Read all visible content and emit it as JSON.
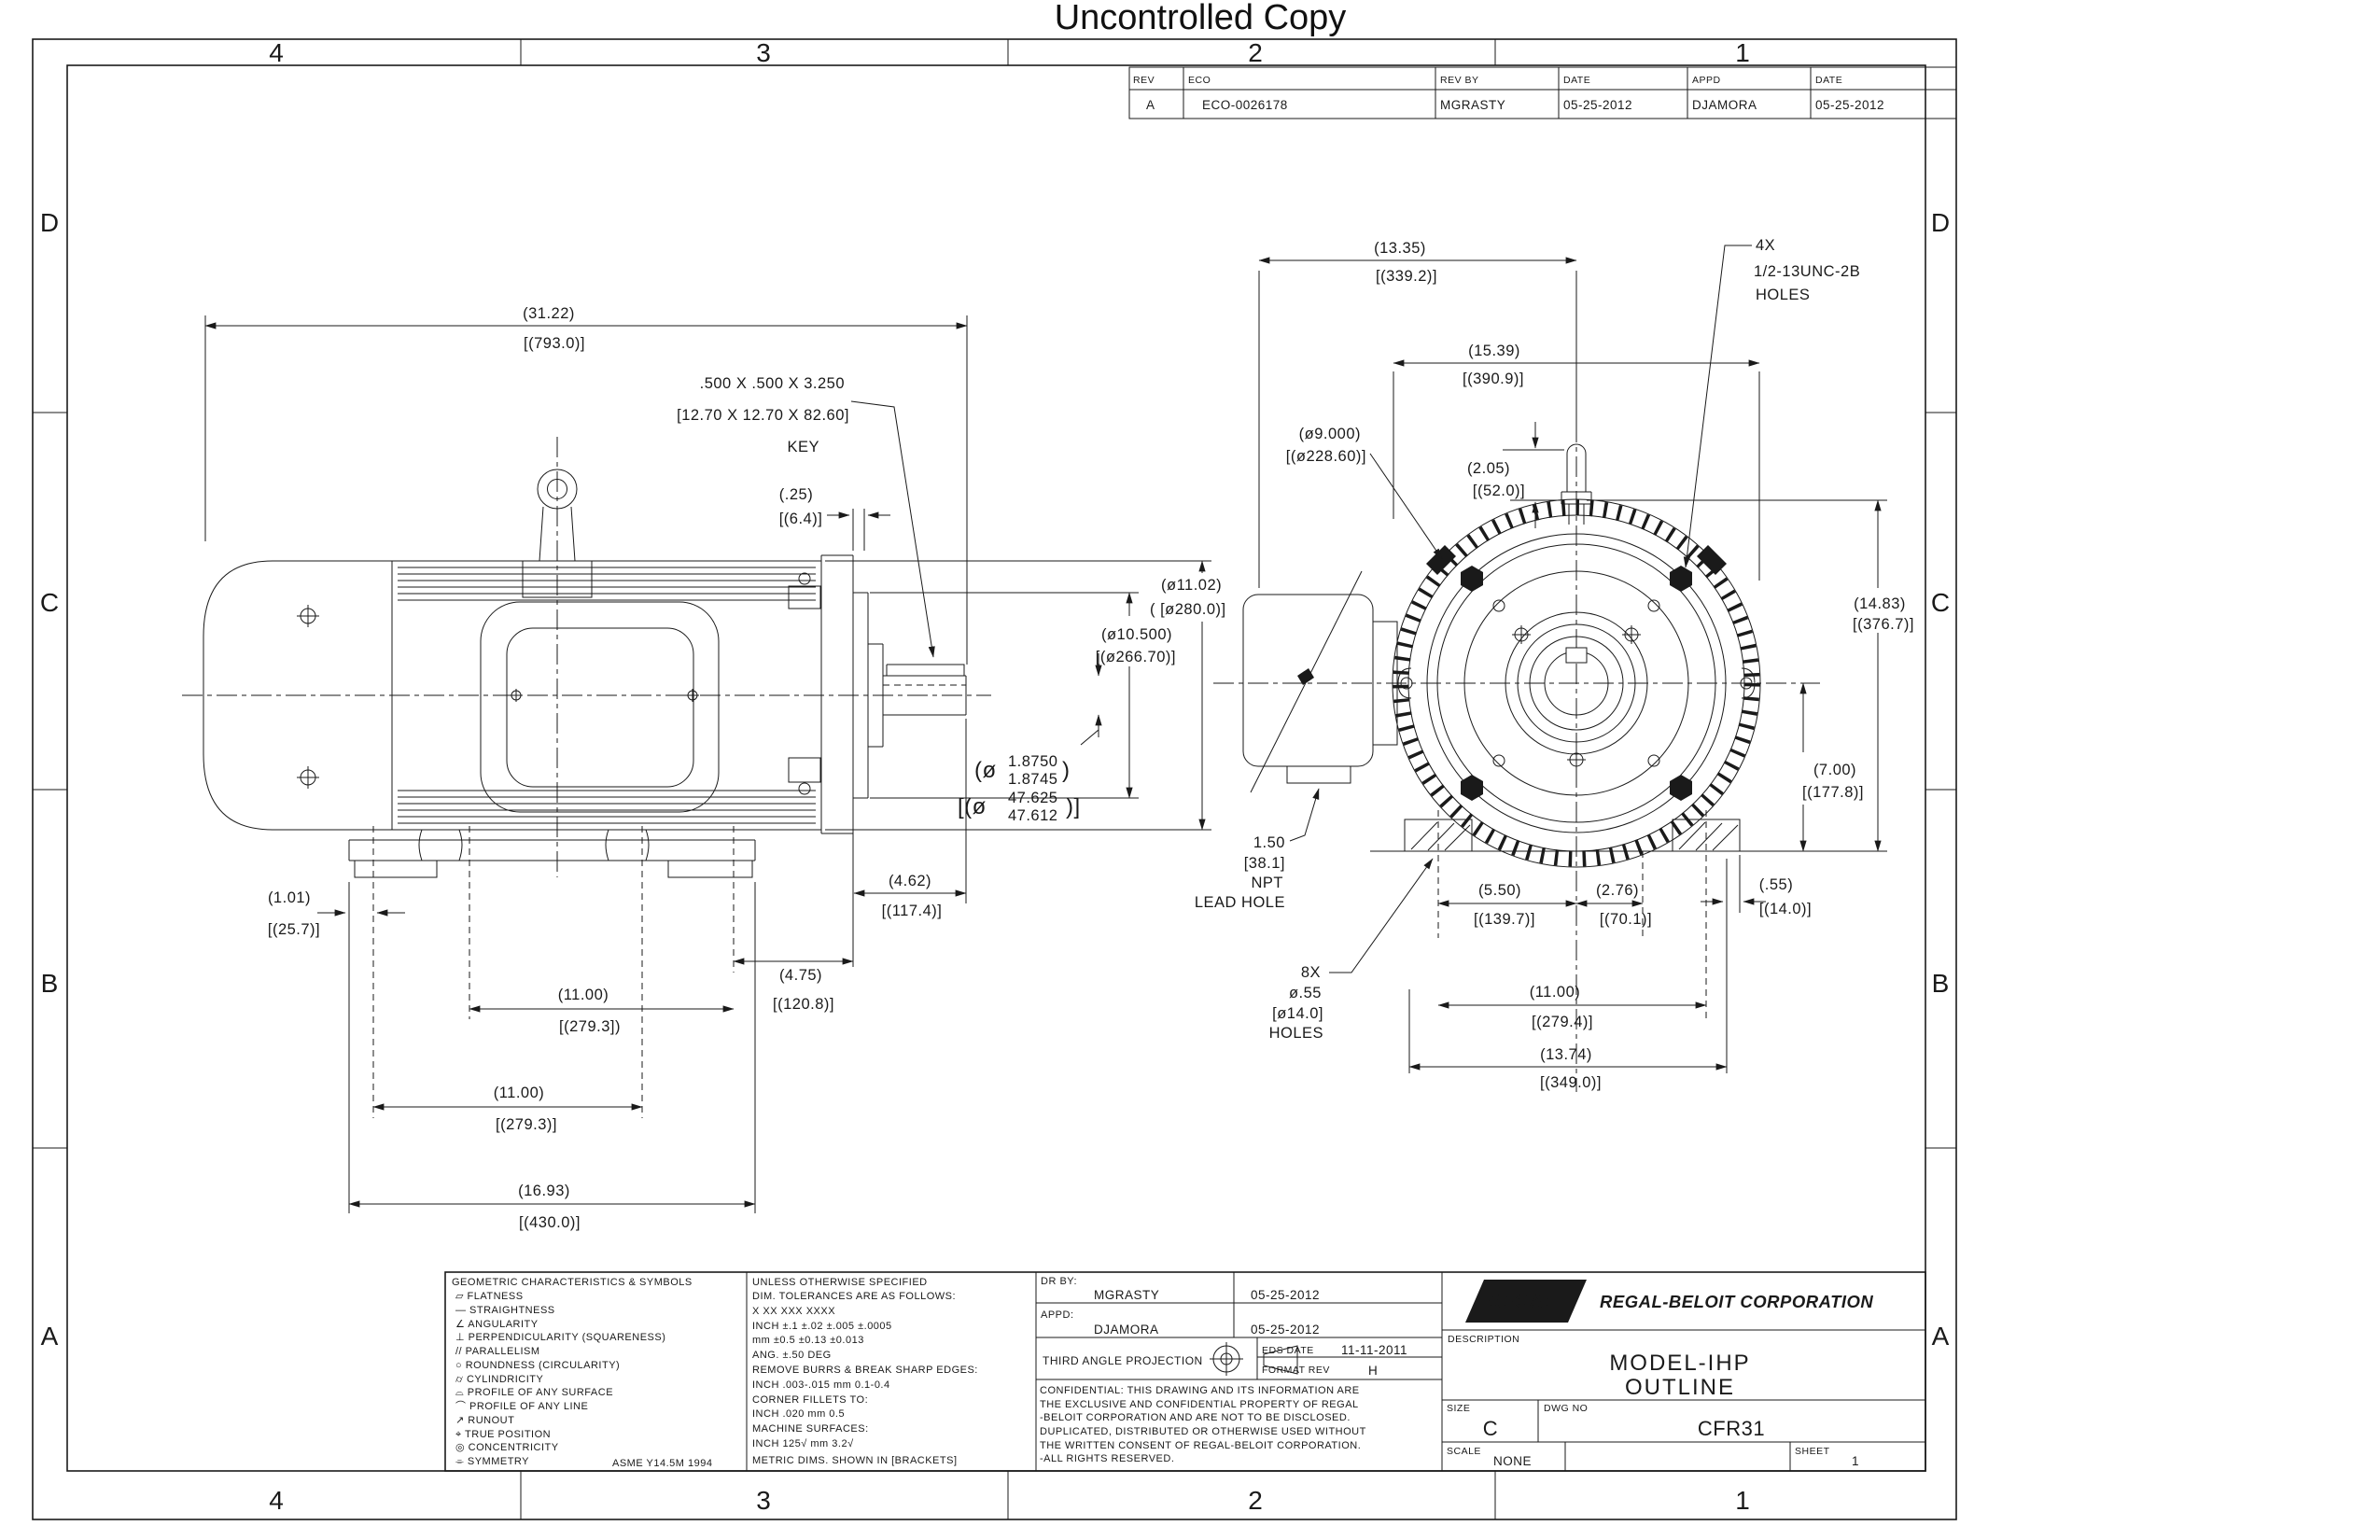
{
  "stamp": "Uncontrolled Copy",
  "zones": {
    "cols": [
      "4",
      "3",
      "2",
      "1"
    ],
    "rows": [
      "D",
      "C",
      "B",
      "A"
    ]
  },
  "revision_table": {
    "h_rev": "REV",
    "h_eco": "ECO",
    "h_rev_by": "REV BY",
    "h_date": "DATE",
    "h_appd": "APPD",
    "h_date2": "DATE",
    "rev": "A",
    "eco": "ECO-0026178",
    "rev_by": "MGRASTY",
    "date": "05-25-2012",
    "appd": "DJAMORA",
    "date2": "05-25-2012"
  },
  "side_view": {
    "overall": {
      "l1": "(31.22)",
      "l2": "[(793.0)]"
    },
    "key_note": {
      "l1": ".500 X .500 X 3.250",
      "l2": "[12.70 X 12.70 X 82.60]",
      "l3": "KEY"
    },
    "gap": {
      "l1": "(.25)",
      "l2": "[(6.4)]"
    },
    "od": {
      "l1": "(ø11.02)",
      "l2": "( [ø280.0)]"
    },
    "rabbet": {
      "l1": "(ø10.500)",
      "l2": "[(ø266.70)]"
    },
    "shaft_in": {
      "pre": "(ø",
      "top": "1.8750",
      "bot": "1.8745",
      "suf": ")"
    },
    "shaft_mm": {
      "pre": "[(ø",
      "top": "47.625",
      "bot": "47.612",
      "suf": ")]"
    },
    "shaft_ext": {
      "l1": "(4.62)",
      "l2": "[(117.4)]"
    },
    "ab": {
      "l1": "(4.75)",
      "l2": "[(120.8)]"
    },
    "foot_edge": {
      "l1": "(1.01)",
      "l2": "[(25.7)]"
    },
    "f1": {
      "l1": "(11.00)",
      "l2": "[(279.3])"
    },
    "f2": {
      "l1": "(11.00)",
      "l2": "[(279.3)]"
    },
    "base_len": {
      "l1": "(16.93)",
      "l2": "[(430.0)]"
    }
  },
  "front_view": {
    "c_dim": {
      "l1": "(13.35)",
      "l2": "[(339.2)]"
    },
    "fin_w": {
      "l1": "(15.39)",
      "l2": "[(390.9)]"
    },
    "tap_holes": {
      "l1": "4X",
      "l2": "1/2-13UNC-2B",
      "l3": "HOLES"
    },
    "ak": {
      "l1": "(ø9.000)",
      "l2": "[(ø228.60)]"
    },
    "stud": {
      "l1": "(2.05)",
      "l2": "[(52.0)]"
    },
    "total_h": {
      "l1": "(14.83)",
      "l2": "[(376.7)]"
    },
    "shaft_h": {
      "l1": "(7.00)",
      "l2": "[(177.8)]"
    },
    "npt": {
      "l1": "1.50",
      "l2": "[38.1]",
      "l3": "NPT",
      "l4": "LEAD HOLE"
    },
    "foot_holes": {
      "l1": "8X",
      "l2": "ø.55",
      "l3": "[ø14.0]",
      "l4": "HOLES"
    },
    "e1": {
      "l1": "(5.50)",
      "l2": "[(139.7)]"
    },
    "e2": {
      "l1": "(2.76)",
      "l2": "[(70.1)]"
    },
    "f3": {
      "l1": "(11.00)",
      "l2": "[(279.4)]"
    },
    "ba": {
      "l1": "(13.74)",
      "l2": "[(349.0)]"
    },
    "edge": {
      "l1": "(.55)",
      "l2": "[(14.0)]"
    }
  },
  "legend": {
    "title": "GEOMETRIC CHARACTERISTICS & SYMBOLS",
    "items": [
      "▱  FLATNESS",
      "—  STRAIGHTNESS",
      "∠  ANGULARITY",
      "⊥  PERPENDICULARITY (SQUARENESS)",
      "//  PARALLELISM",
      "○  ROUNDNESS (CIRCULARITY)",
      "⌭  CYLINDRICITY",
      "⌓  PROFILE OF ANY SURFACE",
      "⌒  PROFILE OF ANY LINE",
      "↗  RUNOUT",
      "⌖  TRUE POSITION",
      "◎  CONCENTRICITY",
      "⌯  SYMMETRY"
    ],
    "standard": "ASME Y14.5M 1994"
  },
  "tolerances": {
    "lines": [
      "UNLESS OTHERWISE SPECIFIED",
      "DIM. TOLERANCES ARE AS FOLLOWS:",
      "           X         XX         XXX        XXXX",
      "INCH   ±.1     ±.02    ±.005   ±.0005",
      "mm      ±0.5   ±0.13  ±0.013",
      "ANG. ±.50 DEG",
      "REMOVE BURRS & BREAK SHARP EDGES:",
      "    INCH .003-.015    mm 0.1-0.4",
      "CORNER FILLETS TO:",
      "    INCH .020    mm 0.5",
      "MACHINE SURFACES:",
      "    INCH 125√    mm 3.2√",
      "METRIC DIMS. SHOWN IN [BRACKETS]"
    ]
  },
  "title_block": {
    "dr_by_label": "DR BY:",
    "dr_by": "MGRASTY",
    "dr_date": "05-25-2012",
    "appd_label": "APPD:",
    "appd": "DJAMORA",
    "appd_date": "05-25-2012",
    "projection": "THIRD ANGLE PROJECTION",
    "eds_label": "EDS DATE",
    "eds_date": "11-11-2011",
    "format_label": "FORMAT REV",
    "format_rev": "H",
    "confidential": [
      "CONFIDENTIAL: THIS DRAWING AND ITS INFORMATION ARE",
      "THE EXCLUSIVE AND CONFIDENTIAL PROPERTY OF REGAL",
      "-BELOIT CORPORATION AND ARE NOT TO BE DISCLOSED.",
      "DUPLICATED, DISTRIBUTED OR OTHERWISE USED WITHOUT",
      "THE WRITTEN CONSENT OF REGAL-BELOIT CORPORATION.",
      "-ALL RIGHTS RESERVED."
    ],
    "logo": "REGAL",
    "company": "REGAL-BELOIT CORPORATION",
    "description_label": "DESCRIPTION",
    "description1": "MODEL-IHP",
    "description2": "OUTLINE",
    "size_label": "SIZE",
    "size": "C",
    "dwg_label": "DWG NO",
    "dwg_no": "CFR31",
    "scale_label": "SCALE",
    "scale": "NONE",
    "sheet_label": "SHEET",
    "sheet": "1"
  }
}
